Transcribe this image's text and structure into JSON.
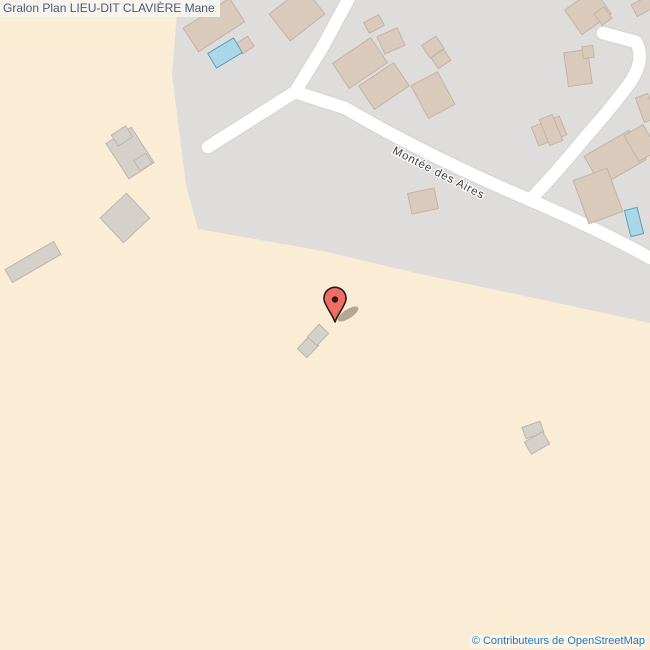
{
  "header": {
    "title": "Gralon Plan LIEU-DIT CLAVIÈRE Mane"
  },
  "footer": {
    "copyright": "© Contributeurs de OpenStreetMap"
  },
  "map": {
    "width": 650,
    "height": 650,
    "colors": {
      "land": "#faecd5",
      "urban_area": "#dedddc",
      "road_fill": "#ffffff",
      "road_casing": "#d8d5d2",
      "building_fill": "#d9cabb",
      "building_stroke": "#c3b3a3",
      "hamlet_building_fill": "#d5d0c9",
      "hamlet_building_stroke": "#bcb6ad",
      "pool_fill": "#a9d7e7",
      "pool_stroke": "#5d9cbd",
      "marker_red": "#ef6d62",
      "marker_outline": "#2b1a16",
      "street_label_color": "#3c3c3c"
    },
    "urban_area_points": "177,0 650,0 650,323 553,302 420,274 323,251 198,229 186,185 172,75 178,0",
    "roads": [
      {
        "name": "montee-des-aires",
        "d": "M208,147 L295,92 L345,108 Q425,155 530,200 Q600,230 650,258"
      },
      {
        "name": "road-north",
        "d": "M295,92 L322,48 L348,0"
      },
      {
        "name": "road-curve-northeast",
        "d": "M603,33 L636,42 Q646,60 629,84 Q608,112 588,134 Q557,172 530,200"
      }
    ],
    "road_width": 12.5,
    "street_label": {
      "text": "Montée des Aires",
      "x": 437,
      "y": 176,
      "rotation": 27,
      "font_size": 11.5
    },
    "buildings": [
      {
        "x": 214,
        "y": 25,
        "w": 55,
        "h": 28,
        "r": -33,
        "type": "urban"
      },
      {
        "x": 245,
        "y": 45,
        "w": 14,
        "h": 12,
        "r": -33,
        "type": "urban"
      },
      {
        "x": 297,
        "y": 14,
        "w": 44,
        "h": 34,
        "r": -38,
        "type": "urban"
      },
      {
        "x": 360,
        "y": 63,
        "w": 46,
        "h": 30,
        "r": -34,
        "type": "urban"
      },
      {
        "x": 384,
        "y": 86,
        "w": 42,
        "h": 28,
        "r": -34,
        "type": "urban"
      },
      {
        "x": 374,
        "y": 24,
        "w": 17,
        "h": 12,
        "r": -28,
        "type": "urban"
      },
      {
        "x": 391,
        "y": 41,
        "w": 22,
        "h": 19,
        "r": -24,
        "type": "urban"
      },
      {
        "x": 433,
        "y": 47,
        "w": 17,
        "h": 15,
        "r": -34,
        "type": "urban"
      },
      {
        "x": 441,
        "y": 59,
        "w": 15,
        "h": 13,
        "r": -34,
        "type": "urban"
      },
      {
        "x": 433,
        "y": 95,
        "w": 30,
        "h": 37,
        "r": -28,
        "type": "urban"
      },
      {
        "x": 588,
        "y": 12,
        "w": 36,
        "h": 30,
        "r": -35,
        "type": "urban"
      },
      {
        "x": 603,
        "y": 16,
        "w": 12,
        "h": 14,
        "r": -35,
        "type": "urban"
      },
      {
        "x": 643,
        "y": 6,
        "w": 20,
        "h": 13,
        "r": -28,
        "type": "urban"
      },
      {
        "x": 578,
        "y": 68,
        "w": 24,
        "h": 34,
        "r": -8,
        "type": "urban"
      },
      {
        "x": 588,
        "y": 52,
        "w": 11,
        "h": 12,
        "r": -8,
        "type": "urban"
      },
      {
        "x": 549,
        "y": 131,
        "w": 30,
        "h": 20,
        "r": -22,
        "type": "urban"
      },
      {
        "x": 551,
        "y": 130,
        "w": 14,
        "h": 28,
        "r": -22,
        "type": "urban"
      },
      {
        "x": 615,
        "y": 158,
        "w": 52,
        "h": 34,
        "r": -30,
        "type": "urban"
      },
      {
        "x": 598,
        "y": 196,
        "w": 36,
        "h": 46,
        "r": -20,
        "type": "urban"
      },
      {
        "x": 641,
        "y": 143,
        "w": 22,
        "h": 30,
        "r": -30,
        "type": "urban"
      },
      {
        "x": 646,
        "y": 108,
        "w": 13,
        "h": 26,
        "r": -20,
        "type": "urban"
      },
      {
        "x": 423,
        "y": 201,
        "w": 27,
        "h": 21,
        "r": -12,
        "type": "urban"
      },
      {
        "x": 130,
        "y": 153,
        "w": 30,
        "h": 42,
        "r": -33,
        "type": "hamlet"
      },
      {
        "x": 122,
        "y": 136,
        "w": 17,
        "h": 13,
        "r": -33,
        "type": "hamlet"
      },
      {
        "x": 143,
        "y": 162,
        "w": 14,
        "h": 12,
        "r": -33,
        "type": "hamlet"
      },
      {
        "x": 125,
        "y": 218,
        "w": 36,
        "h": 34,
        "r": -43,
        "type": "hamlet"
      },
      {
        "x": 33,
        "y": 262,
        "w": 56,
        "h": 15,
        "r": -30,
        "type": "hamlet"
      },
      {
        "x": 308,
        "y": 347,
        "w": 17,
        "h": 13,
        "r": -46,
        "type": "hamlet"
      },
      {
        "x": 318,
        "y": 335,
        "w": 17,
        "h": 13,
        "r": -46,
        "type": "hamlet"
      },
      {
        "x": 533,
        "y": 430,
        "w": 19,
        "h": 12,
        "r": -20,
        "type": "hamlet"
      },
      {
        "x": 537,
        "y": 443,
        "w": 21,
        "h": 14,
        "r": -30,
        "type": "hamlet"
      },
      {
        "x": 225,
        "y": 53,
        "w": 30,
        "h": 17,
        "r": -31,
        "type": "pool"
      },
      {
        "x": 634,
        "y": 222,
        "w": 13,
        "h": 27,
        "r": -14,
        "type": "pool"
      }
    ],
    "marker": {
      "x": 335,
      "y": 300,
      "tip_y": 322,
      "head_radius": 11
    }
  }
}
